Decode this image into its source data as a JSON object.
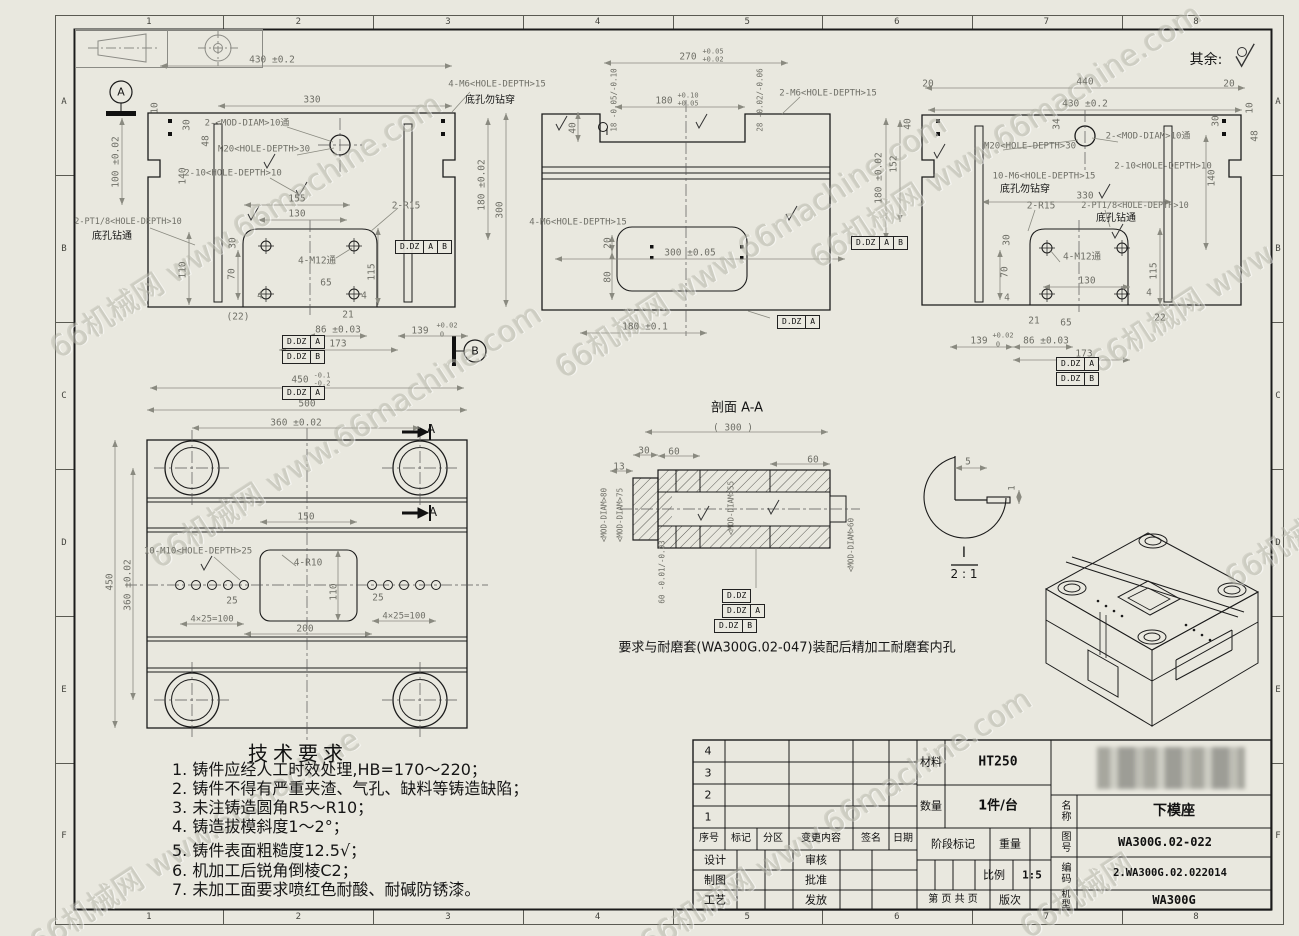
{
  "sheet": {
    "bg": "#e9e8df",
    "line_color": "#1b1b1b",
    "dim_color": "#8a8a80",
    "dim_text_color": "#6f6f67"
  },
  "zones": {
    "cols": [
      "1",
      "2",
      "3",
      "4",
      "5",
      "6",
      "7",
      "8"
    ],
    "rows": [
      "A",
      "B",
      "C",
      "D",
      "E",
      "F"
    ]
  },
  "watermark": {
    "text": "66机械网 www.66machine.com",
    "instances": [
      {
        "x": 40,
        "y": 330,
        "r": -33
      },
      {
        "x": 140,
        "y": 540,
        "r": -33
      },
      {
        "x": 545,
        "y": 350,
        "r": -33
      },
      {
        "x": 800,
        "y": 240,
        "r": -33
      },
      {
        "x": 1080,
        "y": 345,
        "r": -33,
        "t": "66机械网 www"
      },
      {
        "x": 20,
        "y": 925,
        "r": -33,
        "t": "66机械网 www.66machine"
      },
      {
        "x": 630,
        "y": 925,
        "r": -33
      },
      {
        "x": 1010,
        "y": 910,
        "r": -33,
        "t": "66机械网"
      },
      {
        "x": 1215,
        "y": 560,
        "r": -33,
        "t": "66机械网"
      }
    ]
  },
  "tech": {
    "title": "技术要求",
    "items": [
      "1. 铸件应经人工时效处理,HB=170～220；",
      "2. 铸件不得有严重夹渣、气孔、缺料等铸造缺陷；",
      "3. 未注铸造圆角R5～R10；",
      "4. 铸造拔模斜度1～2°；",
      "5. 铸件表面粗糙度12.5√；",
      "6. 机加工后锐角倒棱C2；",
      "7. 未加工面要求喷红色耐酸、耐碱防锈漆。"
    ]
  },
  "title_block": {
    "material_label": "材料",
    "material": "HT250",
    "qty_label": "数量",
    "qty": "1件/台",
    "name_label": "名称",
    "name": "下模座",
    "drawing_no_label": "图号",
    "drawing_no": "WA300G.02-022",
    "code_label": "编码",
    "code": "2.WA300G.02.022014",
    "model_label": "机型",
    "model": "WA300G",
    "stage_label": "阶段标记",
    "weight_label": "重量",
    "scale_label": "比例",
    "scale": "1:5",
    "page_label": "第 页 共 页",
    "rev_label": "版次",
    "header": [
      "序号",
      "标记",
      "分区",
      "变更内容",
      "签名",
      "日期"
    ],
    "rows_left": [
      "设计",
      "制图",
      "工艺"
    ],
    "rows_right": [
      "审核",
      "批准",
      "发放"
    ],
    "rev_numbers": [
      "4",
      "3",
      "2",
      "1"
    ]
  },
  "fcf": [
    {
      "x": 395,
      "y": 240,
      "c": [
        "D.DZ",
        "A",
        "B"
      ]
    },
    {
      "x": 282,
      "y": 335,
      "c": [
        "D.DZ",
        "A"
      ]
    },
    {
      "x": 282,
      "y": 350,
      "c": [
        "D.DZ",
        "B"
      ]
    },
    {
      "x": 282,
      "y": 386,
      "c": [
        "D.DZ",
        "A"
      ]
    },
    {
      "x": 777,
      "y": 315,
      "c": [
        "D.DZ",
        "A"
      ]
    },
    {
      "x": 851,
      "y": 236,
      "c": [
        "D.DZ",
        "A",
        "B"
      ]
    },
    {
      "x": 1056,
      "y": 357,
      "c": [
        "D.DZ",
        "A"
      ]
    },
    {
      "x": 1056,
      "y": 372,
      "c": [
        "D.DZ",
        "B"
      ]
    },
    {
      "x": 722,
      "y": 589,
      "c": [
        "D.DZ"
      ]
    },
    {
      "x": 722,
      "y": 604,
      "c": [
        "D.DZ",
        "A"
      ]
    },
    {
      "x": 714,
      "y": 619,
      "c": [
        "D.DZ",
        "B"
      ]
    }
  ],
  "annotations": [
    {
      "t": "430 ±0.2",
      "x": 272,
      "y": 60
    },
    {
      "t": "330",
      "x": 312,
      "y": 100
    },
    {
      "t": "10",
      "x": 155,
      "y": 108,
      "r": -90
    },
    {
      "t": "100 ±0.02",
      "x": 116,
      "y": 162,
      "r": -90
    },
    {
      "t": "30",
      "x": 187,
      "y": 125,
      "r": -90
    },
    {
      "t": "48",
      "x": 206,
      "y": 141,
      "r": -90
    },
    {
      "t": "140",
      "x": 183,
      "y": 176,
      "r": -90
    },
    {
      "t": "2-<MOD-DIAM>10通",
      "x": 247,
      "y": 124,
      "s": 9
    },
    {
      "t": "M20<HOLE-DEPTH>30",
      "x": 264,
      "y": 150,
      "s": 9
    },
    {
      "t": "2-10<HOLE-DEPTH>10",
      "x": 233,
      "y": 174,
      "s": 9
    },
    {
      "t": "2-PT1/8<HOLE-DEPTH>10",
      "x": 128,
      "y": 222,
      "s": 8.5
    },
    {
      "t": "底孔钻通",
      "x": 112,
      "y": 237,
      "s": 10,
      "k": "c"
    },
    {
      "t": "4-M6<HOLE-DEPTH>15",
      "x": 497,
      "y": 85,
      "s": 9
    },
    {
      "t": "底孔勿钻穿",
      "x": 490,
      "y": 101,
      "s": 10,
      "k": "c"
    },
    {
      "t": "155",
      "x": 297,
      "y": 199
    },
    {
      "t": "130",
      "x": 297,
      "y": 214
    },
    {
      "t": "2-R15",
      "x": 406,
      "y": 206
    },
    {
      "t": "4-M12通",
      "x": 317,
      "y": 261
    },
    {
      "t": "65",
      "x": 326,
      "y": 283
    },
    {
      "t": "110",
      "x": 183,
      "y": 270,
      "r": -90
    },
    {
      "t": "70",
      "x": 232,
      "y": 274,
      "r": -90
    },
    {
      "t": "115",
      "x": 372,
      "y": 272,
      "r": -90
    },
    {
      "t": "30",
      "x": 233,
      "y": 243,
      "r": -90
    },
    {
      "t": "4",
      "x": 260,
      "y": 296
    },
    {
      "t": "4",
      "x": 364,
      "y": 296
    },
    {
      "t": "(22)",
      "x": 238,
      "y": 317
    },
    {
      "t": "21",
      "x": 348,
      "y": 315
    },
    {
      "t": "86 ±0.03",
      "x": 338,
      "y": 330
    },
    {
      "t": "139",
      "x": 420,
      "y": 331
    },
    {
      "t": "+0.02",
      "x": 447,
      "y": 326,
      "s": 7
    },
    {
      "t": "0",
      "x": 442,
      "y": 335,
      "s": 7
    },
    {
      "t": "173",
      "x": 338,
      "y": 344
    },
    {
      "t": "450",
      "x": 300,
      "y": 380
    },
    {
      "t": "-0.1",
      "x": 322,
      "y": 376,
      "s": 7
    },
    {
      "t": "-0.2",
      "x": 322,
      "y": 384,
      "s": 7
    },
    {
      "t": "500",
      "x": 307,
      "y": 404
    },
    {
      "t": "180 ±0.02",
      "x": 482,
      "y": 185,
      "r": -90
    },
    {
      "t": "300",
      "x": 500,
      "y": 210,
      "r": -90
    },
    {
      "t": "A",
      "x": 121,
      "y": 92,
      "s": 11,
      "k": "c"
    },
    {
      "t": "B",
      "x": 475,
      "y": 351,
      "s": 11,
      "k": "c"
    },
    {
      "t": "270",
      "x": 688,
      "y": 57
    },
    {
      "t": "+0.05",
      "x": 713,
      "y": 52,
      "s": 7
    },
    {
      "t": "+0.02",
      "x": 713,
      "y": 60,
      "s": 7
    },
    {
      "t": "18 -0.05/-0.10",
      "x": 614,
      "y": 100,
      "r": -90,
      "s": 7.5
    },
    {
      "t": "180",
      "x": 664,
      "y": 101
    },
    {
      "t": "+0.10",
      "x": 688,
      "y": 96,
      "s": 7
    },
    {
      "t": "+0.05",
      "x": 688,
      "y": 104,
      "s": 7
    },
    {
      "t": "28 -0.02/-0.06",
      "x": 760,
      "y": 100,
      "r": -90,
      "s": 7.5
    },
    {
      "t": "40",
      "x": 573,
      "y": 128,
      "r": -90
    },
    {
      "t": "2-M6<HOLE-DEPTH>15",
      "x": 828,
      "y": 94,
      "s": 9
    },
    {
      "t": "300 ±0.05",
      "x": 690,
      "y": 253
    },
    {
      "t": "4-M6<HOLE-DEPTH>15",
      "x": 578,
      "y": 223,
      "s": 9
    },
    {
      "t": "20",
      "x": 608,
      "y": 243,
      "r": -90
    },
    {
      "t": "80",
      "x": 608,
      "y": 277,
      "r": -90
    },
    {
      "t": "180 ±0.1",
      "x": 645,
      "y": 327
    },
    {
      "t": "I",
      "x": 607,
      "y": 133,
      "s": 10,
      "k": "c"
    },
    {
      "t": "20",
      "x": 928,
      "y": 84
    },
    {
      "t": "440",
      "x": 1085,
      "y": 82
    },
    {
      "t": "20",
      "x": 1229,
      "y": 84
    },
    {
      "t": "430 ±0.2",
      "x": 1085,
      "y": 104
    },
    {
      "t": "10",
      "x": 1250,
      "y": 108,
      "r": -90
    },
    {
      "t": "40",
      "x": 908,
      "y": 124,
      "r": -90
    },
    {
      "t": "34",
      "x": 1057,
      "y": 124,
      "r": -90
    },
    {
      "t": "30",
      "x": 1216,
      "y": 121,
      "r": -90
    },
    {
      "t": "48",
      "x": 1255,
      "y": 136,
      "r": -90
    },
    {
      "t": "152",
      "x": 894,
      "y": 164,
      "r": -90
    },
    {
      "t": "180 ±0.02",
      "x": 879,
      "y": 178,
      "r": -90
    },
    {
      "t": "140",
      "x": 1212,
      "y": 178,
      "r": -90
    },
    {
      "t": "M20<HOLE-DEPTH>30",
      "x": 1030,
      "y": 147,
      "s": 9
    },
    {
      "t": "2-<MOD-DIAM>10通",
      "x": 1148,
      "y": 137,
      "s": 9
    },
    {
      "t": "2-10<HOLE-DEPTH>10",
      "x": 1163,
      "y": 167,
      "s": 9
    },
    {
      "t": "10-M6<HOLE-DEPTH>15",
      "x": 1044,
      "y": 177,
      "s": 9
    },
    {
      "t": "底孔勿钻穿",
      "x": 1025,
      "y": 190,
      "s": 10,
      "k": "c"
    },
    {
      "t": "330",
      "x": 1085,
      "y": 196
    },
    {
      "t": "2-R15",
      "x": 1041,
      "y": 206
    },
    {
      "t": "2-PT1/8<HOLE-DEPTH>10",
      "x": 1135,
      "y": 206,
      "s": 8.5
    },
    {
      "t": "底孔钻通",
      "x": 1116,
      "y": 219,
      "s": 10,
      "k": "c"
    },
    {
      "t": "30",
      "x": 1007,
      "y": 240,
      "r": -90
    },
    {
      "t": "70",
      "x": 1005,
      "y": 272,
      "r": -90
    },
    {
      "t": "4-M12通",
      "x": 1082,
      "y": 257
    },
    {
      "t": "130",
      "x": 1087,
      "y": 281
    },
    {
      "t": "115",
      "x": 1154,
      "y": 271,
      "r": -90
    },
    {
      "t": "4",
      "x": 1007,
      "y": 298
    },
    {
      "t": "4",
      "x": 1149,
      "y": 293
    },
    {
      "t": "21",
      "x": 1034,
      "y": 321
    },
    {
      "t": "65",
      "x": 1066,
      "y": 323
    },
    {
      "t": "22",
      "x": 1160,
      "y": 318
    },
    {
      "t": "86 ±0.03",
      "x": 1046,
      "y": 341
    },
    {
      "t": "139",
      "x": 979,
      "y": 341
    },
    {
      "t": "+0.02",
      "x": 1003,
      "y": 336,
      "s": 7
    },
    {
      "t": "0",
      "x": 998,
      "y": 345,
      "s": 7
    },
    {
      "t": "173",
      "x": 1084,
      "y": 354
    },
    {
      "t": "360 ±0.02",
      "x": 296,
      "y": 423
    },
    {
      "t": "A",
      "x": 431,
      "y": 429,
      "s": 12,
      "k": "c"
    },
    {
      "t": "A",
      "x": 433,
      "y": 512,
      "s": 12,
      "k": "c"
    },
    {
      "t": "150",
      "x": 306,
      "y": 517
    },
    {
      "t": "10-M10<HOLE-DEPTH>25",
      "x": 198,
      "y": 552,
      "s": 9
    },
    {
      "t": "4-R10",
      "x": 308,
      "y": 563
    },
    {
      "t": "110",
      "x": 334,
      "y": 592,
      "r": -90
    },
    {
      "t": "25",
      "x": 232,
      "y": 601
    },
    {
      "t": "25",
      "x": 378,
      "y": 598
    },
    {
      "t": "4×25=100",
      "x": 212,
      "y": 620,
      "s": 9
    },
    {
      "t": "4×25=100",
      "x": 404,
      "y": 617,
      "s": 9
    },
    {
      "t": "200",
      "x": 305,
      "y": 629
    },
    {
      "t": "450",
      "x": 110,
      "y": 582,
      "r": -90
    },
    {
      "t": "360 ±0.02",
      "x": 128,
      "y": 585,
      "r": -90
    },
    {
      "t": "剖面 A-A",
      "x": 737,
      "y": 408,
      "s": 13,
      "k": "c"
    },
    {
      "t": "( 300 )",
      "x": 733,
      "y": 428
    },
    {
      "t": "30",
      "x": 644,
      "y": 451
    },
    {
      "t": "60",
      "x": 674,
      "y": 452
    },
    {
      "t": "60",
      "x": 813,
      "y": 460
    },
    {
      "t": "13",
      "x": 619,
      "y": 467
    },
    {
      "t": "<MOD-DIAM>80",
      "x": 604,
      "y": 515,
      "r": -90,
      "s": 7.5
    },
    {
      "t": "<MOD-DIAM>75",
      "x": 620,
      "y": 515,
      "r": -90,
      "s": 7.5
    },
    {
      "t": "<MOD-DIAM>55",
      "x": 731,
      "y": 508,
      "r": -90,
      "s": 7.5
    },
    {
      "t": "<MOD-DIAM>60",
      "x": 851,
      "y": 545,
      "r": -90,
      "s": 7.5
    },
    {
      "t": "60 -0.01/-0.03",
      "x": 662,
      "y": 572,
      "r": -90,
      "s": 7.5
    },
    {
      "t": "要求与耐磨套(WA300G.02-047)装配后精加工耐磨套内孔",
      "x": 787,
      "y": 648,
      "s": 13,
      "k": "c"
    },
    {
      "t": "5",
      "x": 968,
      "y": 462
    },
    {
      "t": "1",
      "x": 1013,
      "y": 488,
      "r": -90,
      "s": 9
    },
    {
      "t": "I",
      "x": 964,
      "y": 553,
      "s": 14,
      "k": "c"
    },
    {
      "t": "2 : 1",
      "x": 964,
      "y": 574,
      "s": 12,
      "k": "c"
    },
    {
      "t": "其余:",
      "x": 1206,
      "y": 60,
      "s": 14,
      "k": "c"
    }
  ]
}
